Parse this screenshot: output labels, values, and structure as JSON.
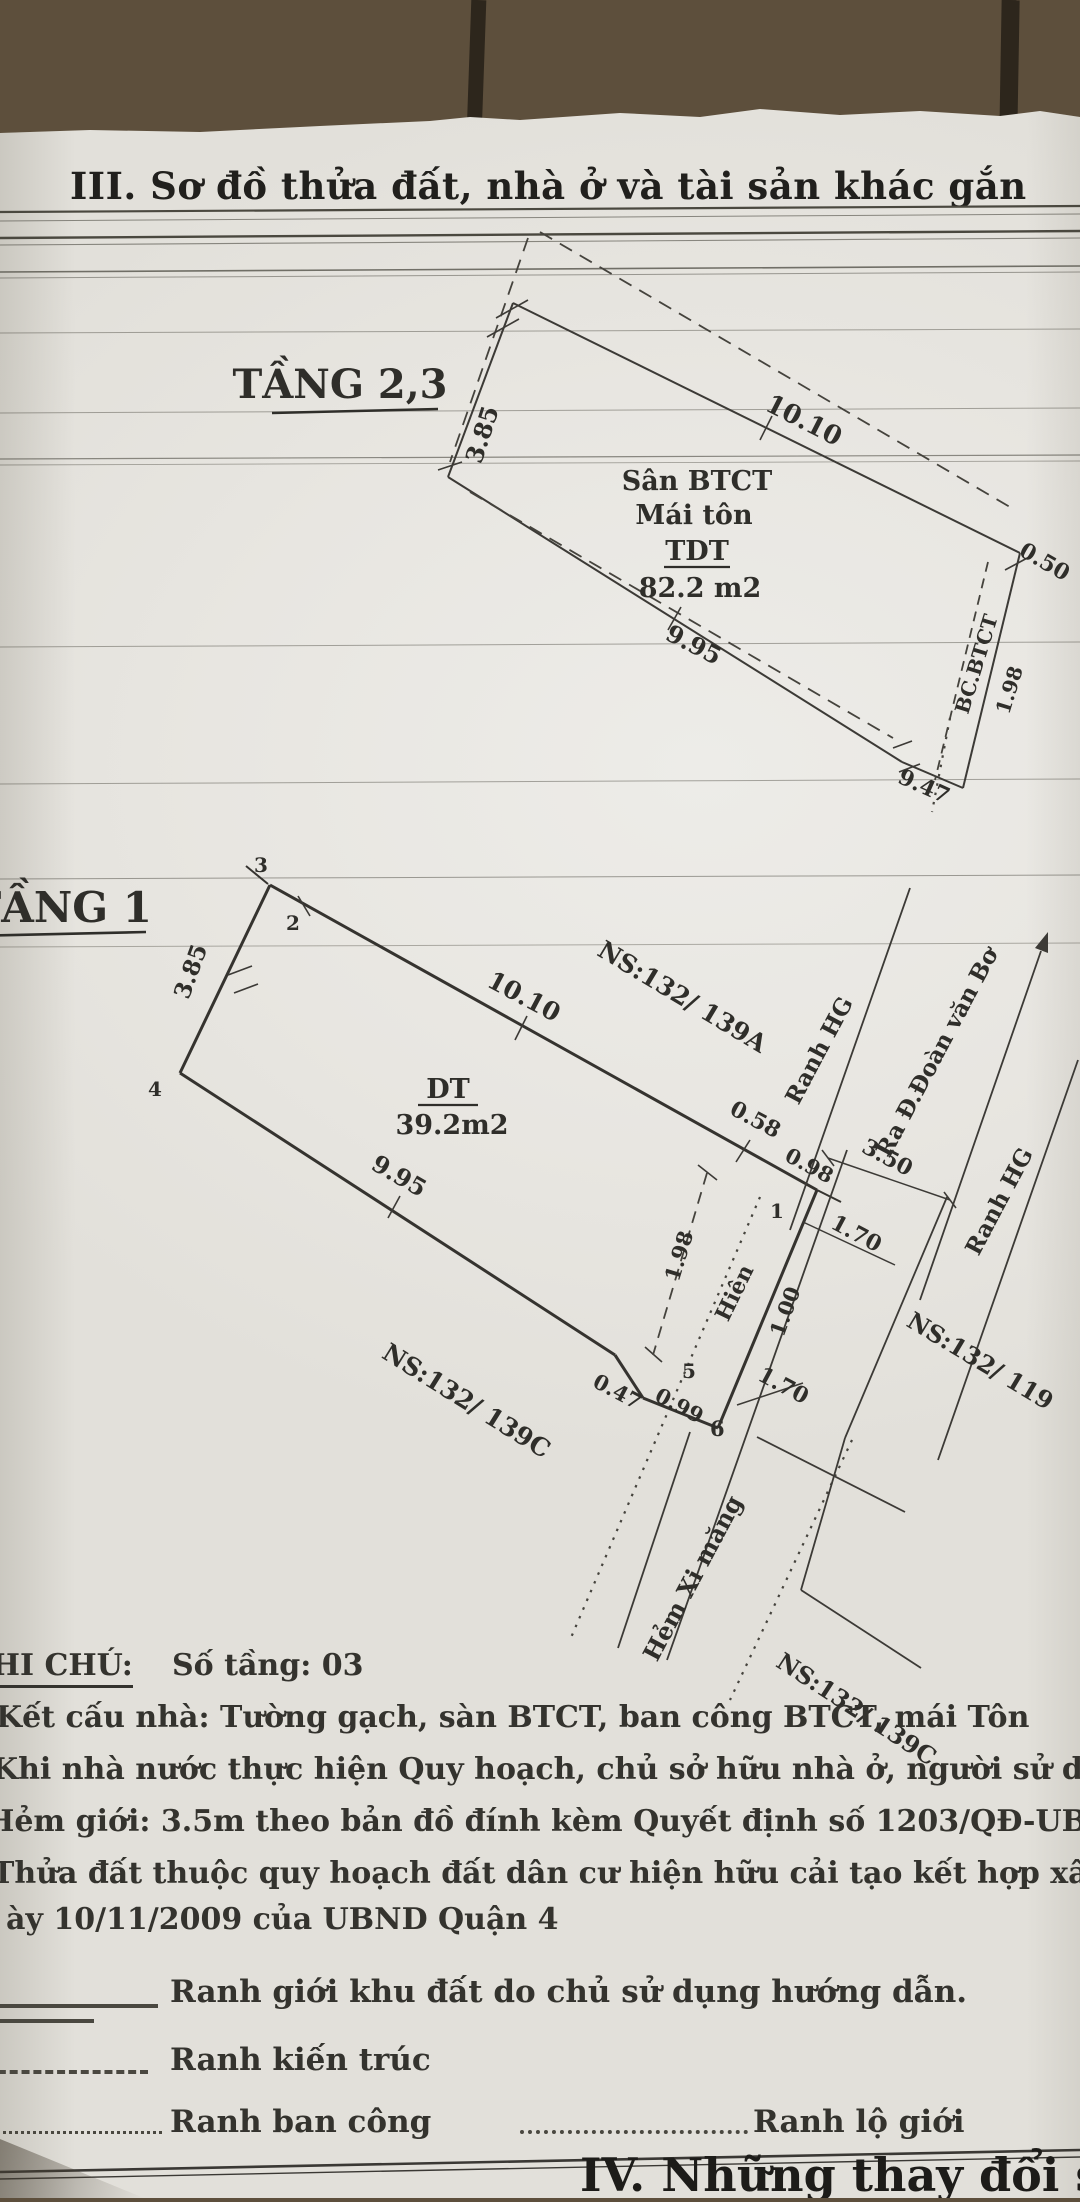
{
  "colors": {
    "paper": "#e8e6e1",
    "ink": "#2f2e2a",
    "wood": "#7d6b52"
  },
  "header": {
    "section_title": "III. Sơ đồ thửa đất, nhà ở và tài sản khác gắn"
  },
  "floor23": {
    "title": "TẦNG 2,3",
    "surface_line1": "Sân BTCT",
    "surface_line2": "Mái tôn",
    "area_label": "TDT",
    "area_value": "82.2 m2",
    "balcony": "BC.BTCT",
    "dims": {
      "d385": "3.85",
      "d1010": "10.10",
      "d995": "9.95",
      "d947": "9.47",
      "d050": "0.50",
      "d198": "1.98"
    }
  },
  "floor1": {
    "title": "TẦNG 1",
    "area_label": "DT",
    "area_value": "39.2m2",
    "dims": {
      "d385": "3.85",
      "d1010": "10.10",
      "d995": "9.95",
      "d058": "0.58",
      "d098": "0.98",
      "d047": "0.47",
      "d099": "0.99",
      "d350": "3.50",
      "d170a": "1.70",
      "d170b": "1.70",
      "d198": "1.98",
      "d100": "1.00"
    },
    "points": {
      "p1": "1",
      "p2": "2",
      "p3": "3",
      "p4": "4",
      "p5": "5",
      "p6": "6"
    },
    "labels": {
      "porch": "Hiên",
      "ns_139a": "NS:132/ 139A",
      "ns_139c_side": "NS:132/ 139C",
      "ns_139c_bottom": "NS:132/ 139C",
      "ns_119": "NS:132/ 119",
      "ranh_hg_1": "Ranh HG",
      "ranh_hg_2": "Ranh HG",
      "ra_street": "Ra Đ.Đoàn văn Bơ",
      "alley": "Hẻm Xi măng"
    }
  },
  "notes": {
    "heading": "GHI CHÚ:",
    "floors": "Số tầng: 03",
    "line1": "Kết cấu nhà: Tường gạch, sàn BTCT, ban công BTCT, mái Tôn",
    "line2": "Khi nhà nước thực hiện Quy hoạch, chủ sở hữu nhà ở, người sử dụng đất phải c",
    "line3": "Hẻm giới: 3.5m theo bản đồ đính kèm Quyết định số 1203/QĐ-UBND-TH ngà",
    "line4": "Thửa đất thuộc quy hoạch đất dân cư hiện hữu cải tạo kết hợp xây dựng, căn cứ",
    "line5": "ày 10/11/2009 của UBND Quận 4"
  },
  "legend": {
    "solid": "Ranh giới khu đất do chủ sử dụng hướng dẫn.",
    "dashed": "Ranh kiến trúc",
    "dotted": "Ranh ban công",
    "dotted2": "Ranh lộ giới"
  },
  "footer": {
    "section_title": "IV. Những thay đổi sau khi cấ"
  }
}
